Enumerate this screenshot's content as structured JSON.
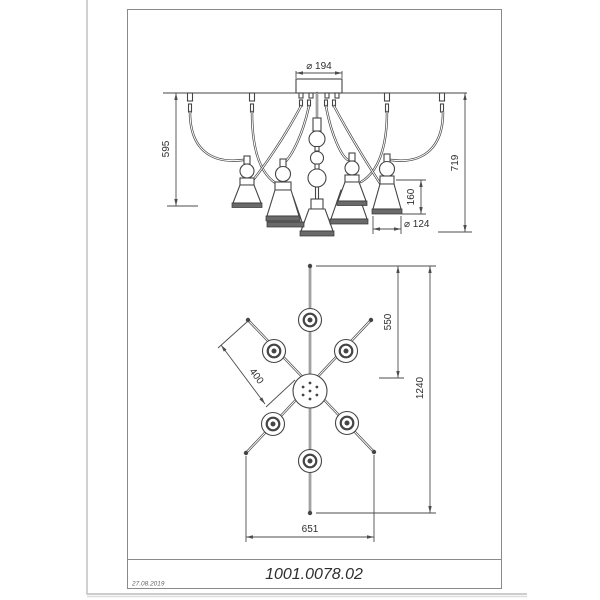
{
  "title_block": {
    "part_number": "1001.0078.02",
    "date": "27.08.2019"
  },
  "side_view": {
    "label": "front-elevation-of-chandelier",
    "dims": {
      "canopy_diameter": "⌀ 194",
      "outer_drop": "595",
      "total_drop": "719",
      "shade_height": "160",
      "shade_diameter": "⌀ 124"
    }
  },
  "plan_view": {
    "label": "top-plan-of-chandelier",
    "dims": {
      "vertical_arm_reach": "550",
      "vertical_span": "1240",
      "diagonal_arm_length": "400",
      "horizontal_span": "651"
    }
  },
  "colors": {
    "line": "#454545",
    "dim": "#4d4d4d",
    "text": "#2e2e2e",
    "frame": "#8a8a8a",
    "band": "#6a6a6a",
    "page_edge": "#bdbdbd"
  }
}
